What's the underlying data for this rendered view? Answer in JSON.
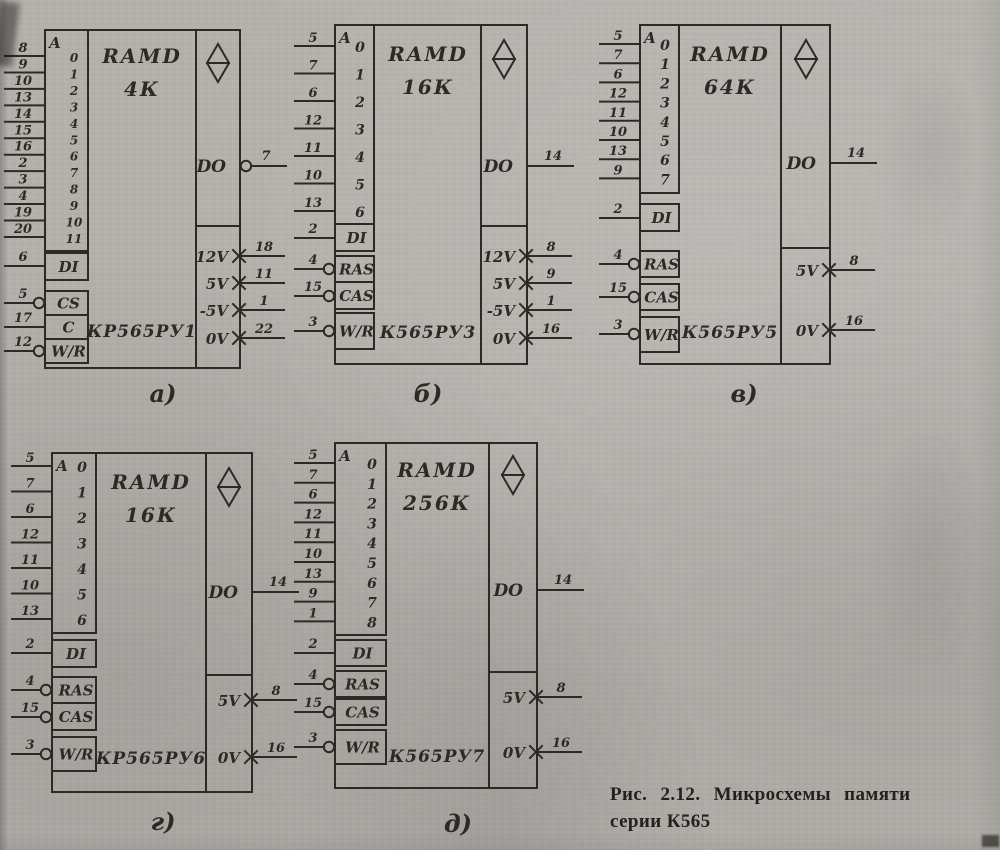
{
  "figure_caption": {
    "line1": "Рис. 2.12. Микросхемы памяти",
    "line2": "серии К565"
  },
  "colors": {
    "ink": "#2b2a24",
    "paper": "#b4b1ac"
  },
  "diagrams": [
    {
      "id": "a",
      "label": "а)",
      "type_label": "RAMD",
      "capacity": "4К",
      "chip_name": "КР565РУ1",
      "address_group": "A",
      "address_lines": [
        {
          "bit": "0",
          "pin": "8"
        },
        {
          "bit": "1",
          "pin": "9"
        },
        {
          "bit": "2",
          "pin": "10"
        },
        {
          "bit": "3",
          "pin": "13"
        },
        {
          "bit": "4",
          "pin": "14"
        },
        {
          "bit": "5",
          "pin": "15"
        },
        {
          "bit": "6",
          "pin": "16"
        },
        {
          "bit": "7",
          "pin": "2"
        },
        {
          "bit": "8",
          "pin": "3"
        },
        {
          "bit": "9",
          "pin": "4"
        },
        {
          "bit": "10",
          "pin": "19"
        },
        {
          "bit": "11",
          "pin": "20"
        }
      ],
      "control_inputs": [
        {
          "label": "DI",
          "pin": "6",
          "inverted": false
        },
        {
          "label": "CS",
          "pin": "5",
          "inverted": true
        },
        {
          "label": "C",
          "pin": "17",
          "inverted": false
        },
        {
          "label": "W/R",
          "pin": "12",
          "inverted": true
        }
      ],
      "output": {
        "label": "DO",
        "pin": "7",
        "inverted_marker": true
      },
      "power_pins": [
        {
          "label": "12V",
          "pin": "18"
        },
        {
          "label": "5V",
          "pin": "11"
        },
        {
          "label": "-5V",
          "pin": "1"
        },
        {
          "label": "0V",
          "pin": "22"
        }
      ]
    },
    {
      "id": "b",
      "label": "б)",
      "type_label": "RAMD",
      "capacity": "16К",
      "chip_name": "К565РУ3",
      "address_group": "A",
      "address_lines": [
        {
          "bit": "0",
          "pin": "5"
        },
        {
          "bit": "1",
          "pin": "7"
        },
        {
          "bit": "2",
          "pin": "6"
        },
        {
          "bit": "3",
          "pin": "12"
        },
        {
          "bit": "4",
          "pin": "11"
        },
        {
          "bit": "5",
          "pin": "10"
        },
        {
          "bit": "6",
          "pin": "13"
        }
      ],
      "control_inputs": [
        {
          "label": "DI",
          "pin": "2",
          "inverted": false
        },
        {
          "label": "RAS",
          "pin": "4",
          "inverted": true
        },
        {
          "label": "CAS",
          "pin": "15",
          "inverted": true
        },
        {
          "label": "W/R",
          "pin": "3",
          "inverted": true
        }
      ],
      "output": {
        "label": "DO",
        "pin": "14",
        "inverted_marker": false
      },
      "power_pins": [
        {
          "label": "12V",
          "pin": "8"
        },
        {
          "label": "5V",
          "pin": "9"
        },
        {
          "label": "-5V",
          "pin": "1"
        },
        {
          "label": "0V",
          "pin": "16"
        }
      ]
    },
    {
      "id": "v",
      "label": "в)",
      "type_label": "RAMD",
      "capacity": "64К",
      "chip_name": "К565РУ5",
      "address_group": "A",
      "address_lines": [
        {
          "bit": "0",
          "pin": "5"
        },
        {
          "bit": "1",
          "pin": "7"
        },
        {
          "bit": "2",
          "pin": "6"
        },
        {
          "bit": "3",
          "pin": "12"
        },
        {
          "bit": "4",
          "pin": "11"
        },
        {
          "bit": "5",
          "pin": "10"
        },
        {
          "bit": "6",
          "pin": "13"
        },
        {
          "bit": "7",
          "pin": "9"
        }
      ],
      "control_inputs": [
        {
          "label": "DI",
          "pin": "2",
          "inverted": false
        },
        {
          "label": "RAS",
          "pin": "4",
          "inverted": true
        },
        {
          "label": "CAS",
          "pin": "15",
          "inverted": true
        },
        {
          "label": "W/R",
          "pin": "3",
          "inverted": true
        }
      ],
      "output": {
        "label": "DO",
        "pin": "14",
        "inverted_marker": false
      },
      "power_pins": [
        {
          "label": "5V",
          "pin": "8"
        },
        {
          "label": "0V",
          "pin": "16"
        }
      ]
    },
    {
      "id": "g",
      "label": "г)",
      "type_label": "RAMD",
      "capacity": "16К",
      "chip_name": "КР565РУ6",
      "address_group": "A",
      "address_lines": [
        {
          "bit": "0",
          "pin": "5"
        },
        {
          "bit": "1",
          "pin": "7"
        },
        {
          "bit": "2",
          "pin": "6"
        },
        {
          "bit": "3",
          "pin": "12"
        },
        {
          "bit": "4",
          "pin": "11"
        },
        {
          "bit": "5",
          "pin": "10"
        },
        {
          "bit": "6",
          "pin": "13"
        }
      ],
      "control_inputs": [
        {
          "label": "DI",
          "pin": "2",
          "inverted": false
        },
        {
          "label": "RAS",
          "pin": "4",
          "inverted": true
        },
        {
          "label": "CAS",
          "pin": "15",
          "inverted": true
        },
        {
          "label": "W/R",
          "pin": "3",
          "inverted": true
        }
      ],
      "output": {
        "label": "DO",
        "pin": "14",
        "inverted_marker": false
      },
      "power_pins": [
        {
          "label": "5V",
          "pin": "8"
        },
        {
          "label": "0V",
          "pin": "16"
        }
      ]
    },
    {
      "id": "d",
      "label": "д)",
      "type_label": "RAMD",
      "capacity": "256К",
      "chip_name": "К565РУ7",
      "address_group": "A",
      "address_lines": [
        {
          "bit": "0",
          "pin": "5"
        },
        {
          "bit": "1",
          "pin": "7"
        },
        {
          "bit": "2",
          "pin": "6"
        },
        {
          "bit": "3",
          "pin": "12"
        },
        {
          "bit": "4",
          "pin": "11"
        },
        {
          "bit": "5",
          "pin": "10"
        },
        {
          "bit": "6",
          "pin": "13"
        },
        {
          "bit": "7",
          "pin": "9"
        },
        {
          "bit": "8",
          "pin": "1"
        }
      ],
      "control_inputs": [
        {
          "label": "DI",
          "pin": "2",
          "inverted": false
        },
        {
          "label": "RAS",
          "pin": "4",
          "inverted": true
        },
        {
          "label": "CAS",
          "pin": "15",
          "inverted": true
        },
        {
          "label": "W/R",
          "pin": "3",
          "inverted": true
        }
      ],
      "output": {
        "label": "DO",
        "pin": "14",
        "inverted_marker": false
      },
      "power_pins": [
        {
          "label": "5V",
          "pin": "8"
        },
        {
          "label": "0V",
          "pin": "16"
        }
      ]
    }
  ]
}
